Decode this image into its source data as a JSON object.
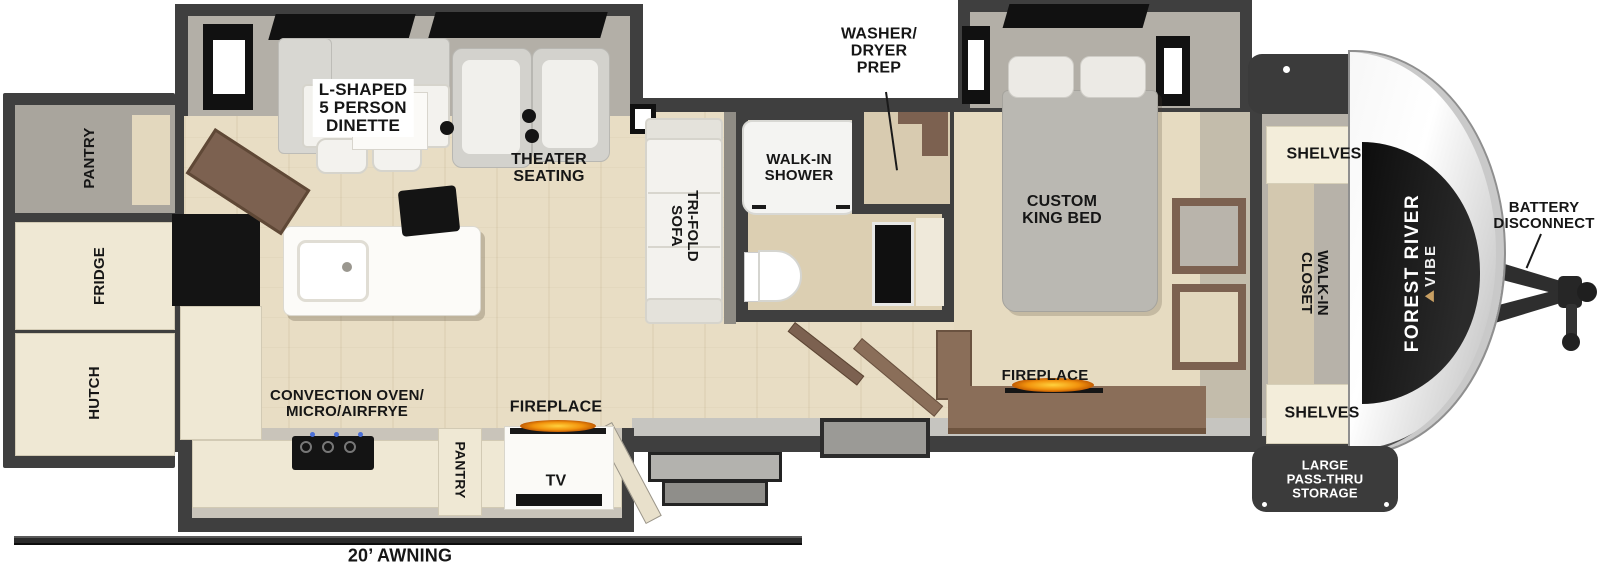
{
  "plan": {
    "title": "Forest River Vibe travel trailer floor plan",
    "brand": {
      "line1": "FOREST RIVER",
      "line2": "VIBE"
    },
    "labels": {
      "rear_pantry": "PANTRY",
      "fridge": "FRIDGE",
      "hutch": "HUTCH",
      "dinette": "L-SHAPED\n5 PERSON\nDINETTE",
      "theater_seating": "THEATER\nSEATING",
      "tri_fold_sofa": "TRI-FOLD\nSOFA",
      "walk_in_shower": "WALK-IN\nSHOWER",
      "washer_dryer_prep": "WASHER/\nDRYER\nPREP",
      "custom_king_bed": "CUSTOM\nKING BED",
      "bedroom_fireplace": "FIREPLACE",
      "shelves_top": "SHELVES",
      "walk_in_closet": "WALK-IN\nCLOSET",
      "shelves_bottom": "SHELVES",
      "battery_disconnect": "BATTERY\nDISCONNECT",
      "convection_oven": "CONVECTION OVEN/\nMICRO/AIRFRYE",
      "kitchen_pantry": "PANTRY",
      "kitchen_fireplace": "FIREPLACE",
      "tv": "TV",
      "pass_thru_storage": "LARGE\nPASS-THRU\nSTORAGE",
      "awning": "20’ AWNING"
    },
    "colors": {
      "wall": "#3F3F3F",
      "floor_wood": "#E8DDC4",
      "cabinet_cream": "#EFE8D4",
      "slide_interior_gray": "#B3AFA7",
      "furniture_brown": "#7C6150",
      "bed_gray": "#BAB8B2",
      "flame_orange": "#F2930D",
      "appliance_black": "#141414",
      "nose_silver": "#D8D8D8",
      "brand_gold": "#C9A063",
      "label_text": "#161616",
      "storage_capsule": "#3B3B3B"
    }
  }
}
